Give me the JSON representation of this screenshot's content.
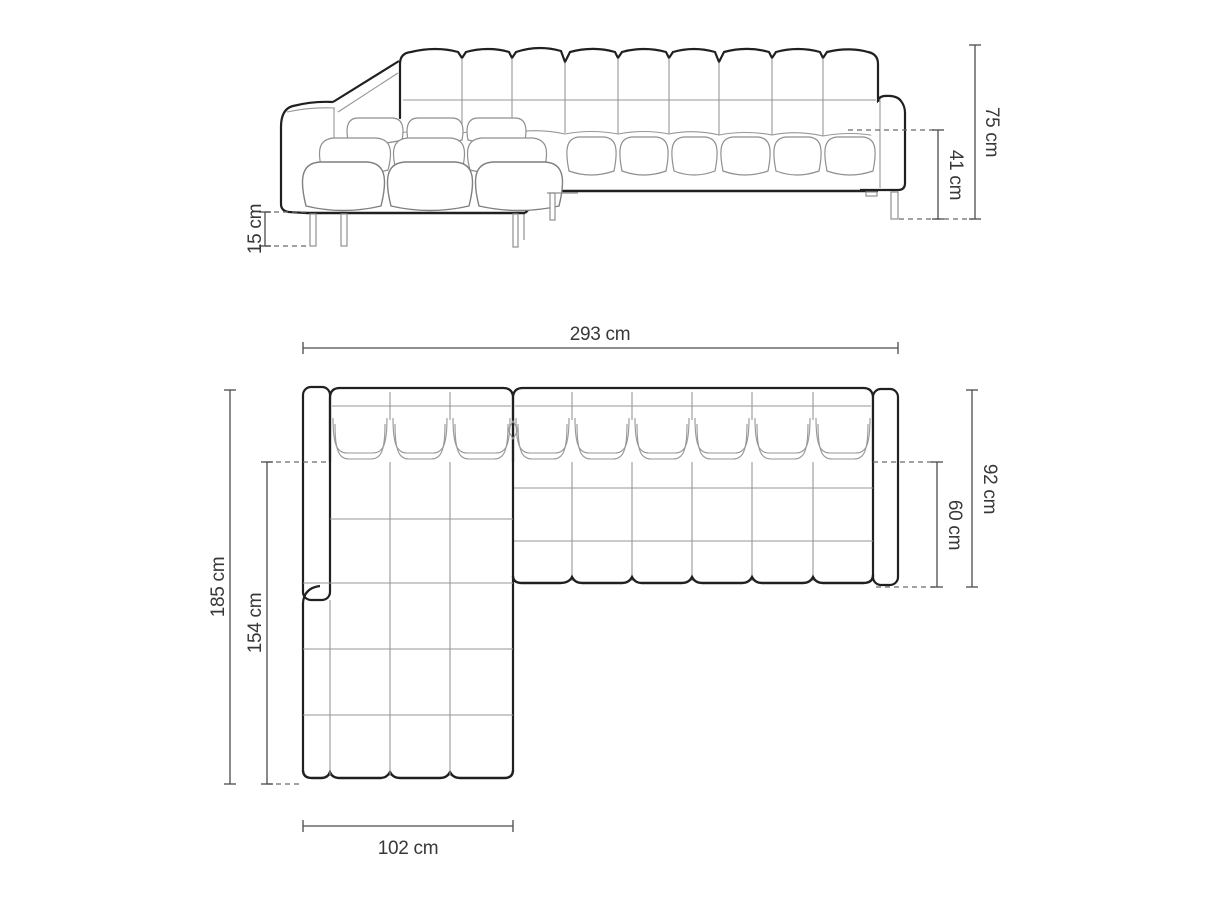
{
  "page": {
    "background": "#ffffff",
    "description": "Technical dimension drawing of a corner sofa with left-hand chaise: front elevation (top) and top plan view (bottom)"
  },
  "drawing": {
    "subject": "corner-sofa-with-chaise",
    "unit": "cm",
    "colors": {
      "outline_dark": "#202020",
      "outline_medium": "#5a5a5a",
      "outline_light": "#979797",
      "dimension_line": "#4a4a4a",
      "text": "#383838",
      "background": "#ffffff"
    },
    "front_view": {
      "name": "front elevation",
      "dims": {
        "total_height": "75 cm",
        "seat_height": "41 cm",
        "leg_height": "15 cm"
      }
    },
    "top_view": {
      "name": "top plan",
      "dims": {
        "total_width": "293 cm",
        "total_depth": "185 cm",
        "chaise_inner_depth": "154 cm",
        "body_depth": "92 cm",
        "seat_depth": "60 cm",
        "chaise_width": "102 cm"
      }
    },
    "dimensions_cm": {
      "total_width": 293,
      "total_depth": 185,
      "total_height": 75,
      "seat_height": 41,
      "leg_height": 15,
      "body_depth": 92,
      "seat_depth": 60,
      "chaise_width": 102,
      "chaise_inner_depth": 154
    }
  }
}
